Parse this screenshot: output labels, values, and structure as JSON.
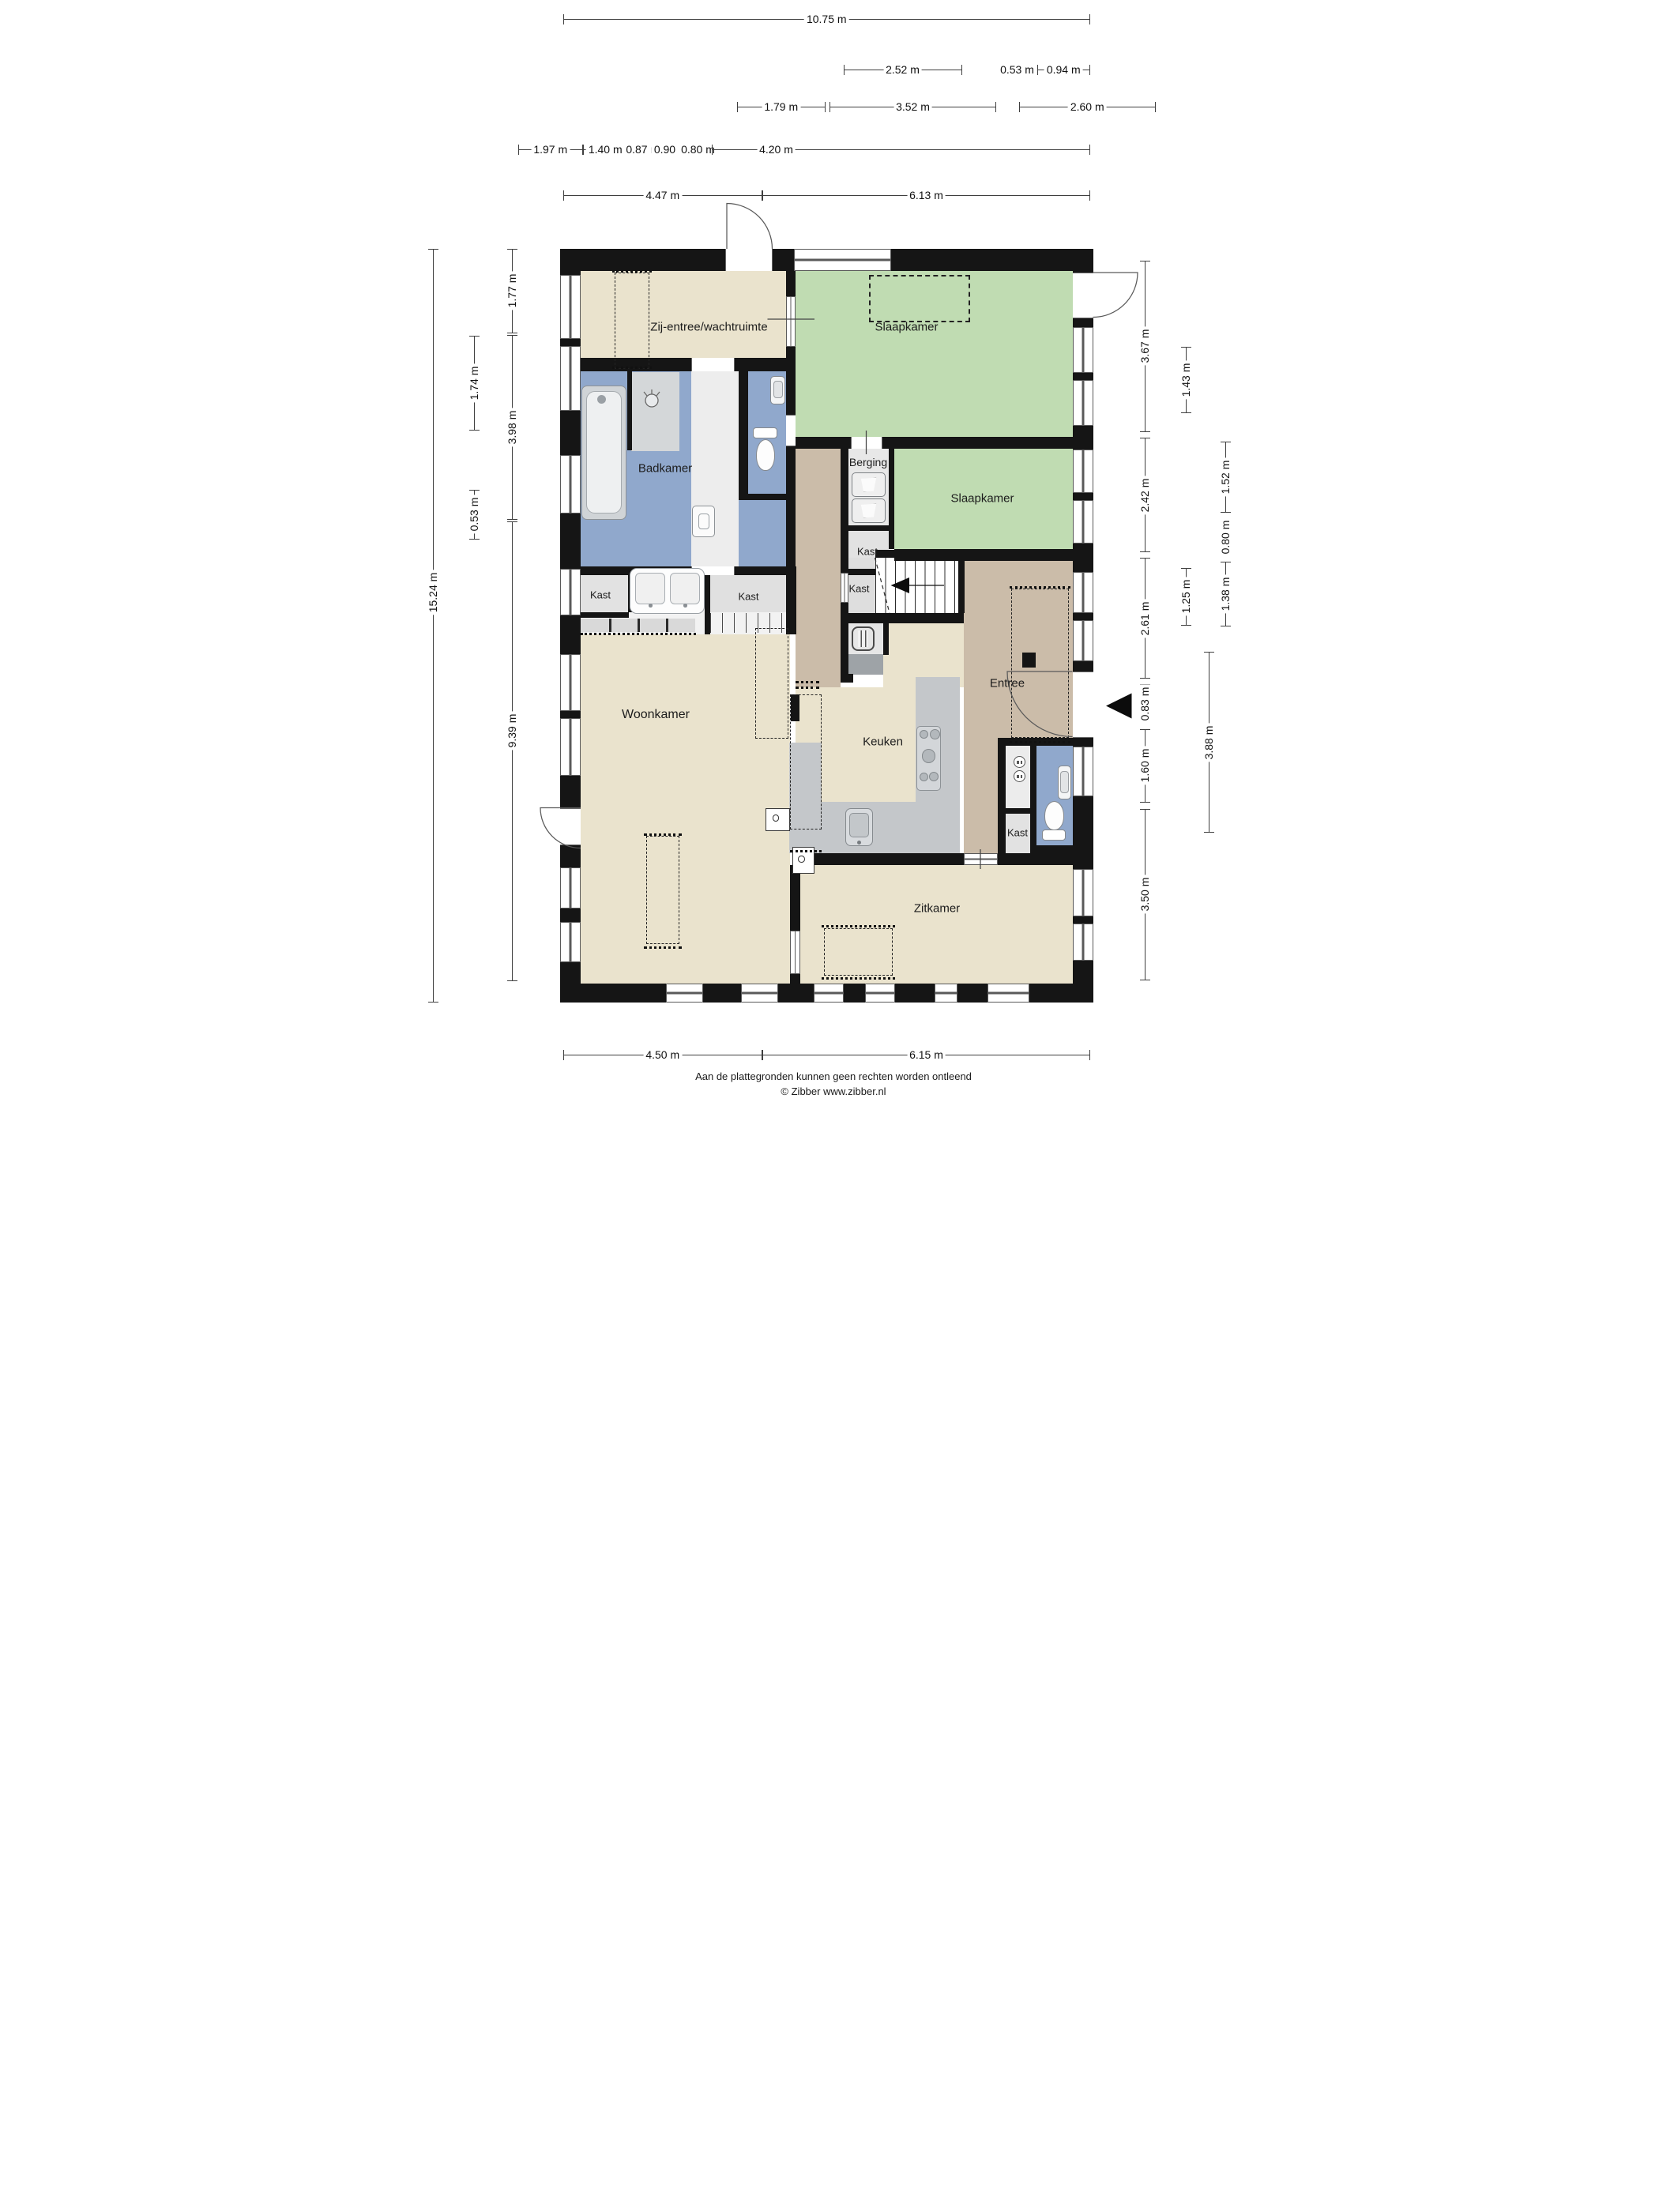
{
  "plan": {
    "rooms": {
      "zij_entree": "Zij-entree/wachtruimte",
      "slaapkamer_1": "Slaapkamer",
      "slaapkamer_2": "Slaapkamer",
      "badkamer": "Badkamer",
      "berging": "Berging",
      "kast_1": "Kast",
      "kast_2": "Kast",
      "kast_3": "Kast",
      "kast_4": "Kast",
      "kast_5": "Kast",
      "woonkamer": "Woonkamer",
      "keuken": "Keuken",
      "entree": "Entree",
      "zitkamer": "Zitkamer"
    },
    "dims": {
      "t1": "10.75 m",
      "t2a": "2.52 m",
      "t2b": "0.53 m",
      "t2c": "0.94 m",
      "t3a": "1.79 m",
      "t3b": "3.52 m",
      "t3c": "2.60 m",
      "t4a": "1.97 m",
      "t4b": "1.40 m",
      "t4c": "0.87 m",
      "t4d": "0.90 m",
      "t4e": "0.80 m",
      "t4f": "4.20 m",
      "t5a": "4.47 m",
      "t5b": "6.13 m",
      "b1": "4.50 m",
      "b2": "6.15 m",
      "l1": "15.24 m",
      "l2": "1.74 m",
      "l3": "0.53 m",
      "l4": "1.77 m",
      "l5": "3.98 m",
      "l6": "9.39 m",
      "r1": "3.67 m",
      "r2": "2.42 m",
      "r3": "2.61 m",
      "r4": "0.83 m",
      "r5": "1.60 m",
      "r6": "3.50 m",
      "r7": "1.43 m",
      "r8": "1.25 m",
      "r9": "1.52 m",
      "r10": "0.80 m",
      "r11": "1.38 m",
      "r12": "3.88 m"
    },
    "footer": {
      "disclaimer": "Aan de plattegronden kunnen geen rechten worden ontleend",
      "copyright": "© Zibber www.zibber.nl"
    }
  }
}
